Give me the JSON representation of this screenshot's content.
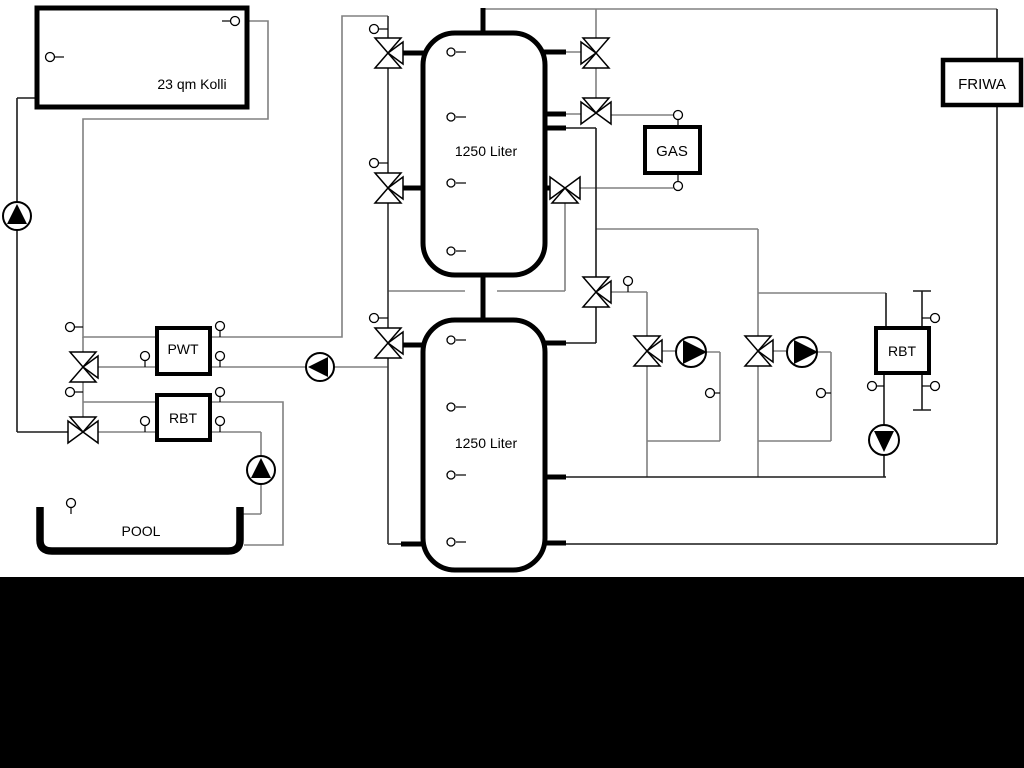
{
  "diagram": {
    "title": "heating-system-hydraulic-schematic",
    "collector": {
      "label": "23 qm Kolli"
    },
    "tank_top": {
      "label": "1250 Liter"
    },
    "tank_bottom": {
      "label": "1250 Liter"
    },
    "pwt": {
      "label": "PWT"
    },
    "rbt_pool": {
      "label": "RBT"
    },
    "rbt_heating": {
      "label": "RBT"
    },
    "gas": {
      "label": "GAS"
    },
    "friwa": {
      "label": "FRIWA"
    },
    "pool": {
      "label": "POOL"
    },
    "colors": {
      "background": "#ffffff",
      "footer_band": "#000000",
      "pipe_gray": "#808080",
      "pipe_black": "#1c1c1c",
      "component_outline": "#000000"
    }
  }
}
